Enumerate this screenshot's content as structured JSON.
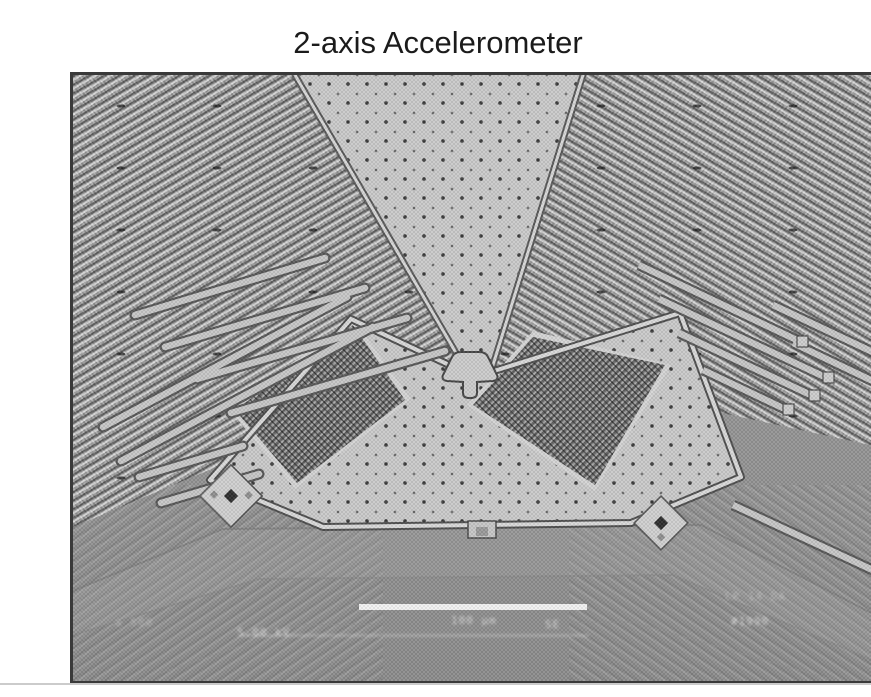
{
  "page": {
    "title": "2-axis Accelerometer",
    "background_color": "#ffffff",
    "divider_color": "#cbcbcb"
  },
  "micrograph": {
    "kind": "SEM image of a MEMS 2-axis accelerometer die",
    "frame_color": "#3a3a3a",
    "hud": {
      "left_label": "a 500",
      "kv_label": "5.00 kV",
      "scale_label": "100 µm",
      "detector_label": "SE",
      "right_label_top": "LP 14 DA",
      "right_label_bottom": "#1990"
    },
    "palette": {
      "substrate": "#959595",
      "proof_mass": "#c9c9c9",
      "sense_plates": "#8c8c8c",
      "comb_arrays": "#a0a0a0",
      "scale_bar": "#f2f2f2"
    }
  }
}
